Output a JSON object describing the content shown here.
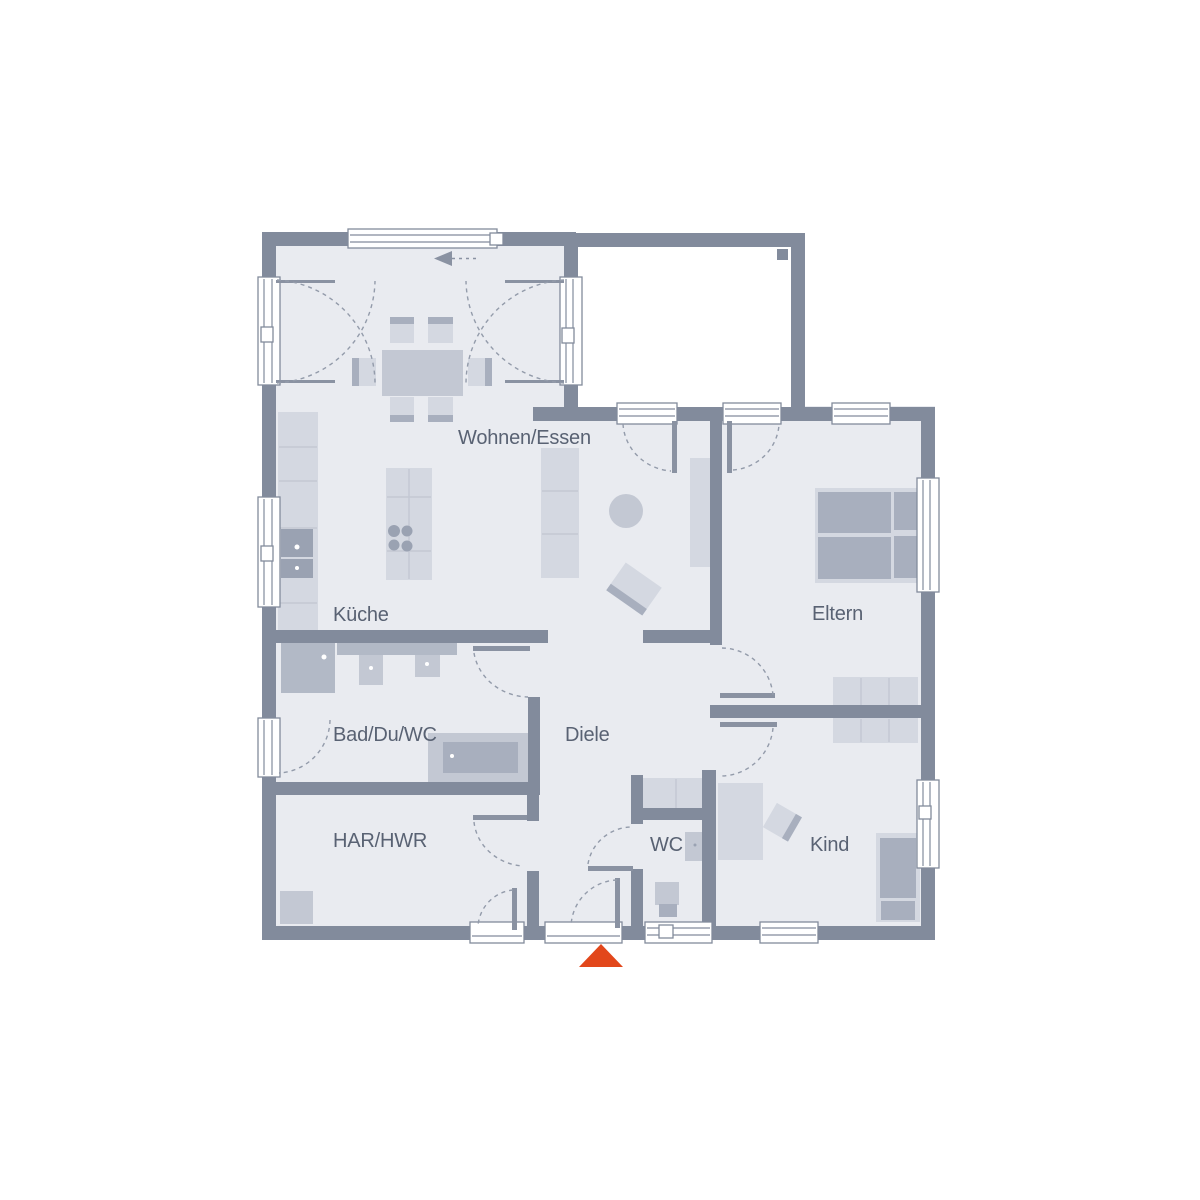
{
  "colors": {
    "background": "#ffffff",
    "wall": "#828b9c",
    "room_fill": "#e9ebf0",
    "terrace_fill": "#ffffff",
    "furniture_light": "#d4d8e1",
    "furniture_mid": "#c3c8d3",
    "furniture_dark": "#a8afbe",
    "appliance": "#9aa2b2",
    "fixture_shade": "#b2b9c6",
    "fixture_line": "#8a92a2",
    "door_arc": "#939baa",
    "label_text": "#596273",
    "entrance_marker": "#e2471b"
  },
  "rooms": {
    "wohnen_essen": {
      "label": "Wohnen/Essen"
    },
    "kueche": {
      "label": "Küche"
    },
    "eltern": {
      "label": "Eltern"
    },
    "bad_du_wc": {
      "label": "Bad/Du/WC"
    },
    "diele": {
      "label": "Diele"
    },
    "har_hwr": {
      "label": "HAR/HWR"
    },
    "wc": {
      "label": "WC"
    },
    "kind": {
      "label": "Kind"
    }
  }
}
